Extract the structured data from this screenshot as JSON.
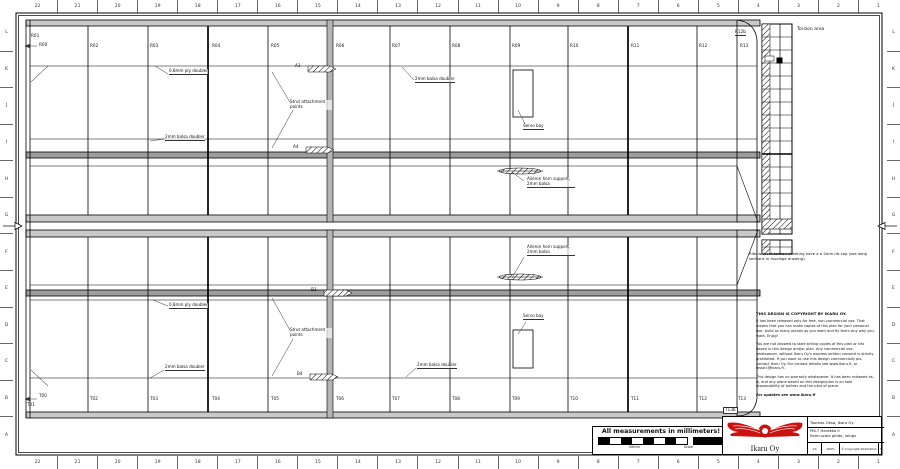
{
  "sheet": {
    "grid_cols": [
      "22",
      "21",
      "20",
      "19",
      "18",
      "17",
      "16",
      "15",
      "14",
      "13",
      "12",
      "11",
      "10",
      "9",
      "8",
      "7",
      "6",
      "5",
      "4",
      "3",
      "2",
      "1"
    ],
    "grid_rows": [
      "L",
      "K",
      "J",
      "I",
      "H",
      "G",
      "F",
      "E",
      "D",
      "C",
      "B",
      "A"
    ]
  },
  "ribs": {
    "top": [
      "R01",
      "R02",
      "R03",
      "R04",
      "R05",
      "R06",
      "R07",
      "R08",
      "R09",
      "R10",
      "R11",
      "R12",
      "R13"
    ],
    "top_root": "R00",
    "top_tip": "R12b",
    "bottom": [
      "T01",
      "T02",
      "T03",
      "T04",
      "T05",
      "T06",
      "T07",
      "T08",
      "T09",
      "T10",
      "T11",
      "T12",
      "T13"
    ],
    "bottom_root": "T00",
    "bottom_tip": "T13b"
  },
  "annotations": {
    "ply_doubler": "0.8mm ply doubler",
    "balsa_doubler": "2mm balsa doubler",
    "strut_points": "Strut attachment points",
    "servo_bay": "Servo bay",
    "aileron_horn": "Aileron horn support, 2mm balsa",
    "torsion_area": "Torsion area",
    "a3": "A3",
    "a4": "A4",
    "b3": "B3",
    "b4": "B4",
    "rib_note": "Ribs without torsion sheeting have a a 2mm rib cap (see wing sections in fuselage drawing)."
  },
  "copyright": {
    "heading": "THIS DESIGN IS COPYRIGHT BY IKARU OY.",
    "p1": "It has been released only for free, non-commercial use. That means that you can make copies of this plan for your personal use, build as many planes as you want and fly them any way you want. Enjoy!",
    "p2": "You are not allowed to start selling copies of this plan or kits based in this design and/or plan. Any commercial use, whatsoever, without Ikaru Oy's express written consent is strictly prohibited. If you want to use this design commercially pls. contact Ikaru Oy. For contact details see www.ikaru.fi, or lasse.t@ikaru.fi.",
    "p3": "This design has no warranty whatsoever. It has been released as-is, and any plane based on this design/plan is on sole responsibility of builder and the pilot of plane.",
    "p4": "For updates see www.ikaru.fi"
  },
  "footer": {
    "measurements": "All measurements in millimeters!",
    "scale_left": "50mm",
    "scale_right": "Scale"
  },
  "titleblock": {
    "company": "Ikaru Oy",
    "author": "Tuomas Oksa, Ikaru Oy",
    "project": "PIK-7 Harakka II",
    "subtitle": "Semi-scale glider, wings",
    "sheet_size": "A3",
    "scale": "100%",
    "copyright": "© Copyright 2010/2011",
    "rev": "%",
    "logo_red": "#cc1111"
  }
}
